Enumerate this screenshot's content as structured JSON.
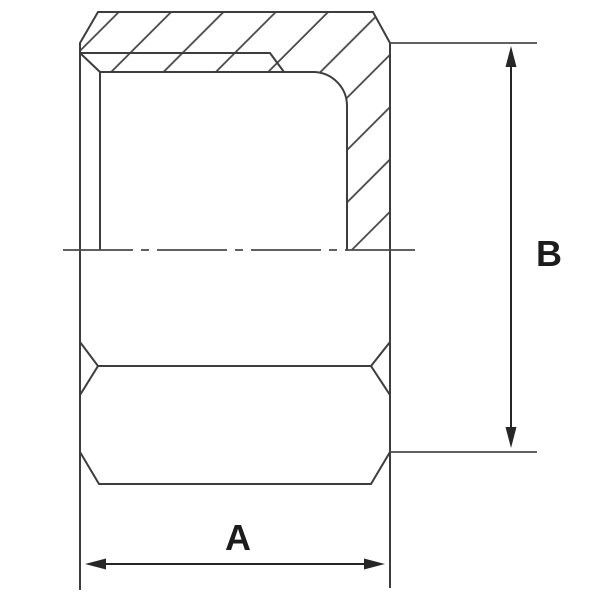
{
  "drawing": {
    "kind": "sectioned hex cap technical drawing",
    "labels": {
      "width_dimension": "A",
      "height_dimension": "B"
    },
    "colors": {
      "background": "#ffffff",
      "part_line": "#3d3d3d",
      "hatch_line": "#424242",
      "centerline": "#4a4a4a",
      "extension_line": "#4a4a4a",
      "dimension_line": "#262626",
      "label_text": "#1c1c1c"
    }
  }
}
